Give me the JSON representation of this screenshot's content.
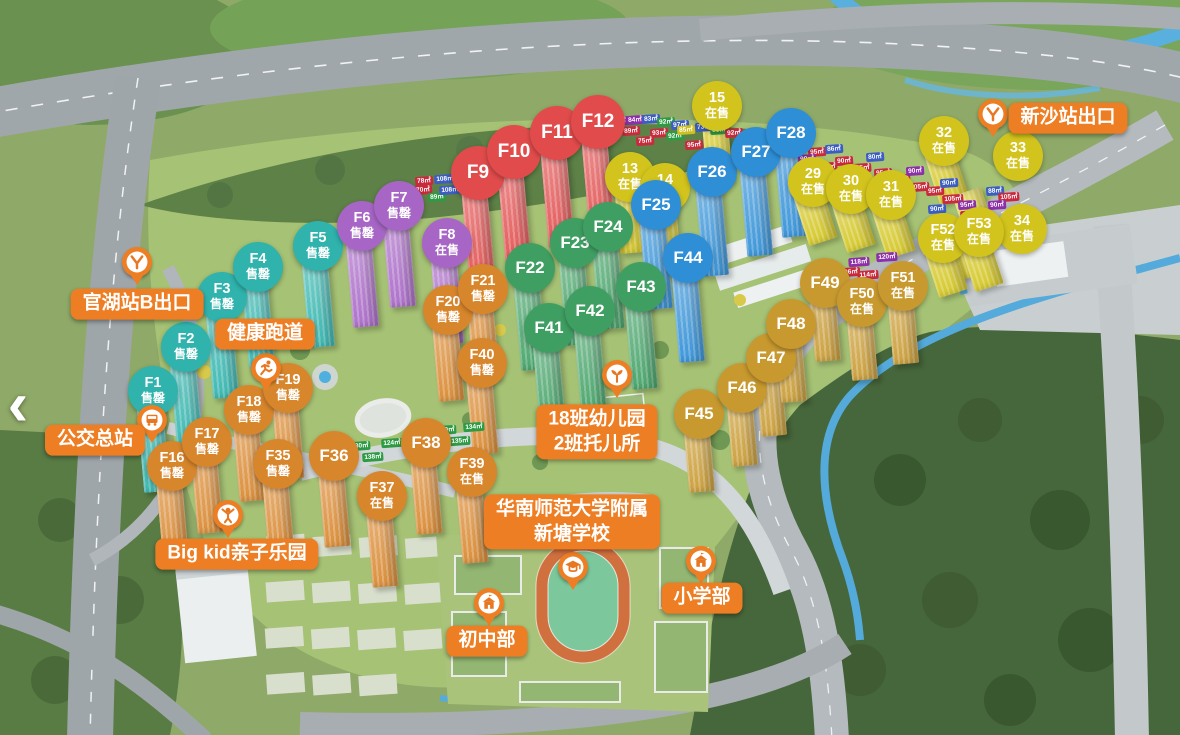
{
  "nav": {
    "back_arrow": "‹"
  },
  "palette": {
    "label_bg": "#ee7e23",
    "groups": {
      "teal": "#2fb3ac",
      "purple": "#a766c5",
      "red": "#e14b4b",
      "yellowTop": "#d2c41c",
      "green": "#3f9f62",
      "blue": "#2e8ed6",
      "orange": "#d8862c",
      "yellowRight": "#d2c41c",
      "gold": "#c8992f"
    },
    "chips": {
      "r": "#c92a3d",
      "b": "#3c5ec2",
      "p": "#8d2fa8",
      "g": "#2d9b43",
      "y": "#cfc01f"
    }
  },
  "markers": [
    {
      "label": "F1",
      "status": "售罄",
      "group": "teal",
      "x": 153,
      "y": 391
    },
    {
      "label": "F2",
      "status": "售罄",
      "group": "teal",
      "x": 186,
      "y": 347
    },
    {
      "label": "F3",
      "status": "售罄",
      "group": "teal",
      "x": 222,
      "y": 297
    },
    {
      "label": "F4",
      "status": "售罄",
      "group": "teal",
      "x": 258,
      "y": 267
    },
    {
      "label": "F5",
      "status": "售罄",
      "group": "teal",
      "x": 318,
      "y": 246
    },
    {
      "label": "F6",
      "status": "售罄",
      "group": "purple",
      "x": 362,
      "y": 226
    },
    {
      "label": "F7",
      "status": "售罄",
      "group": "purple",
      "x": 399,
      "y": 206
    },
    {
      "label": "F8",
      "status": "在售",
      "group": "purple",
      "x": 447,
      "y": 243
    },
    {
      "label": "F9",
      "status": "",
      "group": "red",
      "x": 478,
      "y": 173
    },
    {
      "label": "F10",
      "status": "",
      "group": "red",
      "x": 514,
      "y": 152
    },
    {
      "label": "F11",
      "status": "",
      "group": "red",
      "x": 557,
      "y": 133
    },
    {
      "label": "F12",
      "status": "",
      "group": "red",
      "x": 598,
      "y": 122
    },
    {
      "label": "13",
      "status": "在售",
      "group": "yellowTop",
      "x": 630,
      "y": 177
    },
    {
      "label": "14",
      "status": "在售",
      "group": "yellowTop",
      "x": 665,
      "y": 188
    },
    {
      "label": "15",
      "status": "在售",
      "group": "yellowTop",
      "x": 717,
      "y": 106
    },
    {
      "label": "F22",
      "status": "",
      "group": "green",
      "x": 530,
      "y": 268
    },
    {
      "label": "F23",
      "status": "",
      "group": "green",
      "x": 575,
      "y": 243
    },
    {
      "label": "F24",
      "status": "",
      "group": "green",
      "x": 608,
      "y": 227
    },
    {
      "label": "F41",
      "status": "",
      "group": "green",
      "x": 549,
      "y": 328
    },
    {
      "label": "F42",
      "status": "",
      "group": "green",
      "x": 590,
      "y": 311
    },
    {
      "label": "F43",
      "status": "",
      "group": "green",
      "x": 641,
      "y": 287
    },
    {
      "label": "F25",
      "status": "",
      "group": "blue",
      "x": 656,
      "y": 205
    },
    {
      "label": "F26",
      "status": "",
      "group": "blue",
      "x": 712,
      "y": 172
    },
    {
      "label": "F27",
      "status": "",
      "group": "blue",
      "x": 756,
      "y": 152
    },
    {
      "label": "F28",
      "status": "",
      "group": "blue",
      "x": 791,
      "y": 133
    },
    {
      "label": "F44",
      "status": "",
      "group": "blue",
      "x": 688,
      "y": 258
    },
    {
      "label": "F16",
      "status": "售罄",
      "group": "orange",
      "x": 172,
      "y": 466
    },
    {
      "label": "F17",
      "status": "售罄",
      "group": "orange",
      "x": 207,
      "y": 442
    },
    {
      "label": "F18",
      "status": "售罄",
      "group": "orange",
      "x": 249,
      "y": 410
    },
    {
      "label": "F19",
      "status": "售罄",
      "group": "orange",
      "x": 288,
      "y": 388
    },
    {
      "label": "F20",
      "status": "售罄",
      "group": "orange",
      "x": 448,
      "y": 310
    },
    {
      "label": "F21",
      "status": "售罄",
      "group": "orange",
      "x": 483,
      "y": 289
    },
    {
      "label": "F35",
      "status": "售罄",
      "group": "orange",
      "x": 278,
      "y": 464
    },
    {
      "label": "F36",
      "status": "",
      "group": "orange",
      "x": 334,
      "y": 456
    },
    {
      "label": "F37",
      "status": "在售",
      "group": "orange",
      "x": 382,
      "y": 496
    },
    {
      "label": "F38",
      "status": "",
      "group": "orange",
      "x": 426,
      "y": 443
    },
    {
      "label": "F39",
      "status": "在售",
      "group": "orange",
      "x": 472,
      "y": 472
    },
    {
      "label": "F40",
      "status": "售罄",
      "group": "orange",
      "x": 482,
      "y": 363
    },
    {
      "label": "29",
      "status": "在售",
      "group": "yellowRight",
      "x": 813,
      "y": 182
    },
    {
      "label": "30",
      "status": "在售",
      "group": "yellowRight",
      "x": 851,
      "y": 189
    },
    {
      "label": "31",
      "status": "在售",
      "group": "yellowRight",
      "x": 891,
      "y": 195
    },
    {
      "label": "32",
      "status": "在售",
      "group": "yellowRight",
      "x": 944,
      "y": 141
    },
    {
      "label": "33",
      "status": "在售",
      "group": "yellowRight",
      "x": 1018,
      "y": 156,
      "tdx": -45,
      "tdy": 28
    },
    {
      "label": "34",
      "status": "在售",
      "group": "yellowRight",
      "x": 1022,
      "y": 229,
      "tdx": -60,
      "tdy": -12
    },
    {
      "label": "F52",
      "status": "在售",
      "group": "yellowRight",
      "x": 943,
      "y": 238,
      "tdy": -4
    },
    {
      "label": "F53",
      "status": "在售",
      "group": "yellowRight",
      "x": 979,
      "y": 232,
      "tdy": -4
    },
    {
      "label": "F45",
      "status": "",
      "group": "gold",
      "x": 699,
      "y": 414
    },
    {
      "label": "F46",
      "status": "",
      "group": "gold",
      "x": 742,
      "y": 388
    },
    {
      "label": "F47",
      "status": "",
      "group": "gold",
      "x": 771,
      "y": 358
    },
    {
      "label": "F48",
      "status": "",
      "group": "gold",
      "x": 791,
      "y": 324
    },
    {
      "label": "F49",
      "status": "",
      "group": "gold",
      "x": 825,
      "y": 283
    },
    {
      "label": "F50",
      "status": "在售",
      "group": "gold",
      "x": 862,
      "y": 302
    },
    {
      "label": "F51",
      "status": "在售",
      "group": "gold",
      "x": 903,
      "y": 286
    }
  ],
  "amenities": [
    {
      "id": "guanhu-exit",
      "lines": [
        "官湖站B出口"
      ],
      "x": 137,
      "y": 304,
      "pin": {
        "icon": "metro",
        "x": 137,
        "y": 262
      }
    },
    {
      "id": "bus-terminal",
      "lines": [
        "公交总站"
      ],
      "x": 95,
      "y": 440,
      "pin": {
        "icon": "bus",
        "x": 152,
        "y": 420
      }
    },
    {
      "id": "health-track",
      "lines": [
        "健康跑道"
      ],
      "x": 265,
      "y": 334,
      "pin": {
        "icon": "runner",
        "x": 266,
        "y": 368
      }
    },
    {
      "id": "bigkid-park",
      "lines": [
        "Big kid亲子乐园"
      ],
      "x": 237,
      "y": 554,
      "pin": {
        "icon": "kid",
        "x": 228,
        "y": 515
      }
    },
    {
      "id": "kindergarten",
      "lines": [
        "18班幼儿园",
        "2班托儿所"
      ],
      "x": 597,
      "y": 432,
      "pin": {
        "icon": "sprout",
        "x": 617,
        "y": 375
      }
    },
    {
      "id": "affiliated-school",
      "lines": [
        "华南师范大学附属",
        "新塘学校"
      ],
      "x": 572,
      "y": 522,
      "pin": {
        "icon": "cap",
        "x": 573,
        "y": 567
      }
    },
    {
      "id": "primary-section",
      "lines": [
        "小学部"
      ],
      "x": 702,
      "y": 598,
      "pin": {
        "icon": "school",
        "x": 701,
        "y": 561
      }
    },
    {
      "id": "junior-section",
      "lines": [
        "初中部"
      ],
      "x": 487,
      "y": 641,
      "pin": {
        "icon": "school",
        "x": 489,
        "y": 603
      }
    },
    {
      "id": "xinsha-exit",
      "lines": [
        "新沙站出口"
      ],
      "x": 1068,
      "y": 118,
      "pin": {
        "icon": "metro",
        "x": 993,
        "y": 114
      }
    }
  ],
  "chips": [
    {
      "t": "78㎡",
      "c": "r",
      "x": 424,
      "y": 181
    },
    {
      "t": "70㎡",
      "c": "r",
      "x": 423,
      "y": 190
    },
    {
      "t": "108㎡",
      "c": "b",
      "x": 445,
      "y": 179
    },
    {
      "t": "89㎡",
      "c": "g",
      "x": 437,
      "y": 197
    },
    {
      "t": "108㎡",
      "c": "b",
      "x": 450,
      "y": 190
    },
    {
      "t": "83㎡",
      "c": "p",
      "x": 619,
      "y": 121
    },
    {
      "t": "84㎡",
      "c": "p",
      "x": 635,
      "y": 120
    },
    {
      "t": "80㎡",
      "c": "b",
      "x": 616,
      "y": 130
    },
    {
      "t": "89㎡",
      "c": "r",
      "x": 631,
      "y": 131
    },
    {
      "t": "83㎡",
      "c": "b",
      "x": 651,
      "y": 119
    },
    {
      "t": "92㎡",
      "c": "g",
      "x": 666,
      "y": 122
    },
    {
      "t": "97㎡",
      "c": "b",
      "x": 680,
      "y": 125
    },
    {
      "t": "93㎡",
      "c": "r",
      "x": 659,
      "y": 133
    },
    {
      "t": "92㎡",
      "c": "g",
      "x": 675,
      "y": 136
    },
    {
      "t": "75㎡",
      "c": "r",
      "x": 645,
      "y": 141
    },
    {
      "t": "85㎡",
      "c": "y",
      "x": 686,
      "y": 130
    },
    {
      "t": "95㎡",
      "c": "r",
      "x": 694,
      "y": 145
    },
    {
      "t": "73㎡",
      "c": "b",
      "x": 704,
      "y": 127
    },
    {
      "t": "85㎡",
      "c": "g",
      "x": 719,
      "y": 130
    },
    {
      "t": "92㎡",
      "c": "r",
      "x": 734,
      "y": 133
    },
    {
      "t": "78㎡",
      "c": "r",
      "x": 749,
      "y": 137
    },
    {
      "t": "101㎡",
      "c": "b",
      "x": 764,
      "y": 140
    },
    {
      "t": "121㎡",
      "c": "g",
      "x": 745,
      "y": 148
    },
    {
      "t": "85㎡",
      "c": "r",
      "x": 778,
      "y": 144
    },
    {
      "t": "105㎡",
      "c": "r",
      "x": 801,
      "y": 147
    },
    {
      "t": "95㎡",
      "c": "r",
      "x": 817,
      "y": 152
    },
    {
      "t": "86㎡",
      "c": "b",
      "x": 834,
      "y": 149
    },
    {
      "t": "90㎡",
      "c": "p",
      "x": 807,
      "y": 159
    },
    {
      "t": "90㎡",
      "c": "r",
      "x": 844,
      "y": 161
    },
    {
      "t": "108㎡",
      "c": "r",
      "x": 827,
      "y": 167
    },
    {
      "t": "105㎡",
      "c": "r",
      "x": 861,
      "y": 168
    },
    {
      "t": "80㎡",
      "c": "b",
      "x": 875,
      "y": 157
    },
    {
      "t": "95㎡",
      "c": "r",
      "x": 883,
      "y": 173
    },
    {
      "t": "108㎡",
      "c": "r",
      "x": 900,
      "y": 179
    },
    {
      "t": "90㎡",
      "c": "p",
      "x": 915,
      "y": 171
    },
    {
      "t": "105㎡",
      "c": "r",
      "x": 919,
      "y": 187
    },
    {
      "t": "95㎡",
      "c": "r",
      "x": 935,
      "y": 191
    },
    {
      "t": "90㎡",
      "c": "b",
      "x": 949,
      "y": 183
    },
    {
      "t": "105㎡",
      "c": "r",
      "x": 953,
      "y": 199
    },
    {
      "t": "95㎡",
      "c": "p",
      "x": 967,
      "y": 205
    },
    {
      "t": "90㎡",
      "c": "b",
      "x": 937,
      "y": 209
    },
    {
      "t": "108㎡",
      "c": "r",
      "x": 971,
      "y": 215
    },
    {
      "t": "88㎡",
      "c": "b",
      "x": 995,
      "y": 191
    },
    {
      "t": "105㎡",
      "c": "r",
      "x": 1009,
      "y": 197
    },
    {
      "t": "90㎡",
      "c": "p",
      "x": 997,
      "y": 205
    },
    {
      "t": "105㎡",
      "c": "r",
      "x": 984,
      "y": 224
    },
    {
      "t": "118㎡",
      "c": "p",
      "x": 859,
      "y": 262
    },
    {
      "t": "96㎡",
      "c": "r",
      "x": 851,
      "y": 272
    },
    {
      "t": "114㎡",
      "c": "r",
      "x": 868,
      "y": 275
    },
    {
      "t": "120㎡",
      "c": "p",
      "x": 887,
      "y": 257
    },
    {
      "t": "130㎡",
      "c": "g",
      "x": 360,
      "y": 446
    },
    {
      "t": "124㎡",
      "c": "g",
      "x": 392,
      "y": 443
    },
    {
      "t": "138㎡",
      "c": "g",
      "x": 373,
      "y": 457
    },
    {
      "t": "130㎡",
      "c": "g",
      "x": 446,
      "y": 430
    },
    {
      "t": "134㎡",
      "c": "g",
      "x": 474,
      "y": 427
    },
    {
      "t": "135㎡",
      "c": "g",
      "x": 460,
      "y": 441
    }
  ]
}
